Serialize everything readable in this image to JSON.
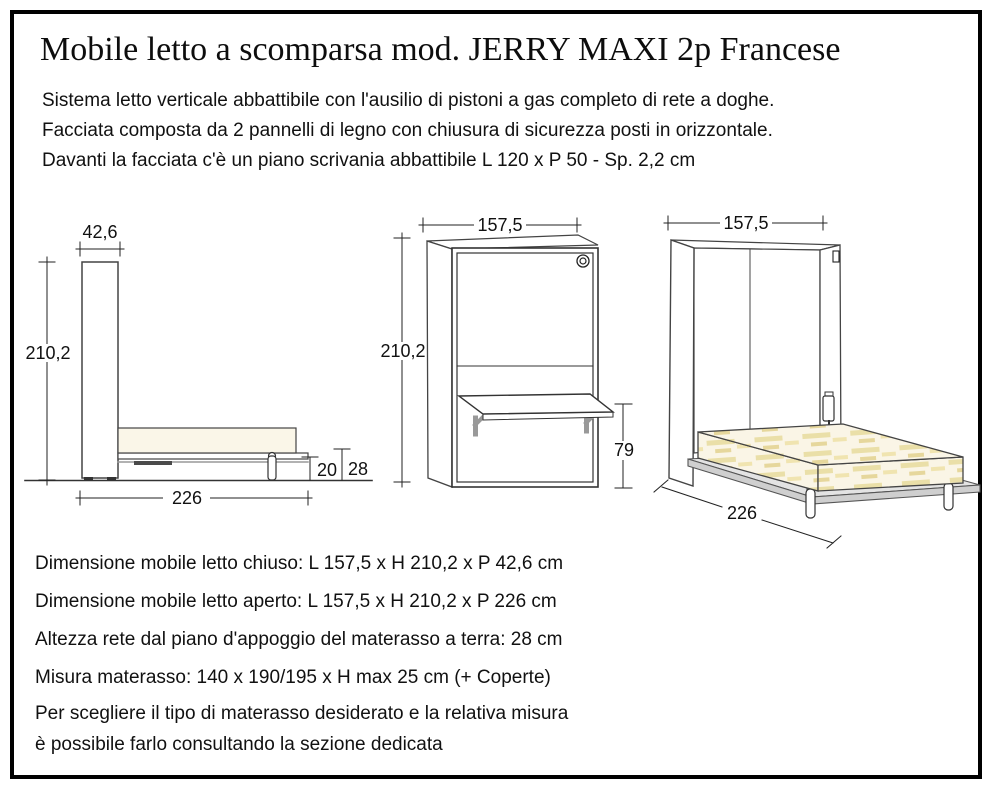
{
  "title": "Mobile letto a scomparsa mod. JERRY MAXI 2p Francese",
  "description": {
    "line1": "Sistema letto verticale abbattibile con l'ausilio di pistoni a gas completo di rete a doghe.",
    "line2": "Facciata composta da 2 pannelli di legno con chiusura di sicurezza posti in orizzontale.",
    "line3": "Davanti la facciata c'è un piano scrivania abbattibile L 120  x P 50 - Sp. 2,2 cm"
  },
  "drawings": {
    "side_open": {
      "depth_closed": "42,6",
      "height": "210,2",
      "length_open": "226",
      "frame_floor_gap": "20",
      "bed_height": "28"
    },
    "front_closed": {
      "width": "157,5",
      "height": "210,2",
      "desk_height": "79"
    },
    "perspective_open": {
      "width": "157,5",
      "length_open": "226"
    }
  },
  "specs": {
    "closed": "Dimensione mobile letto chiuso: L 157,5 x H 210,2 x P 42,6 cm",
    "open": "Dimensione mobile letto aperto: L 157,5 x H 210,2 x P 226 cm",
    "slat_height": "Altezza rete dal piano d'appoggio del materasso a terra: 28 cm",
    "mattress": "Misura materasso: 140 x 190/195 x H max 25 cm (+ Coperte)"
  },
  "note": {
    "line1": "Per scegliere il tipo di materasso desiderato e la relativa misura",
    "line2": "è possibile farlo consultando la sezione dedicata"
  },
  "colors": {
    "mattress_fill": "#faf6e8",
    "mattress_texture": "#eadfa8",
    "frame_gray": "#e3e3e3",
    "bracket_gray": "#999999",
    "line_color": "#3a3a3a",
    "border_black": "#000000"
  }
}
